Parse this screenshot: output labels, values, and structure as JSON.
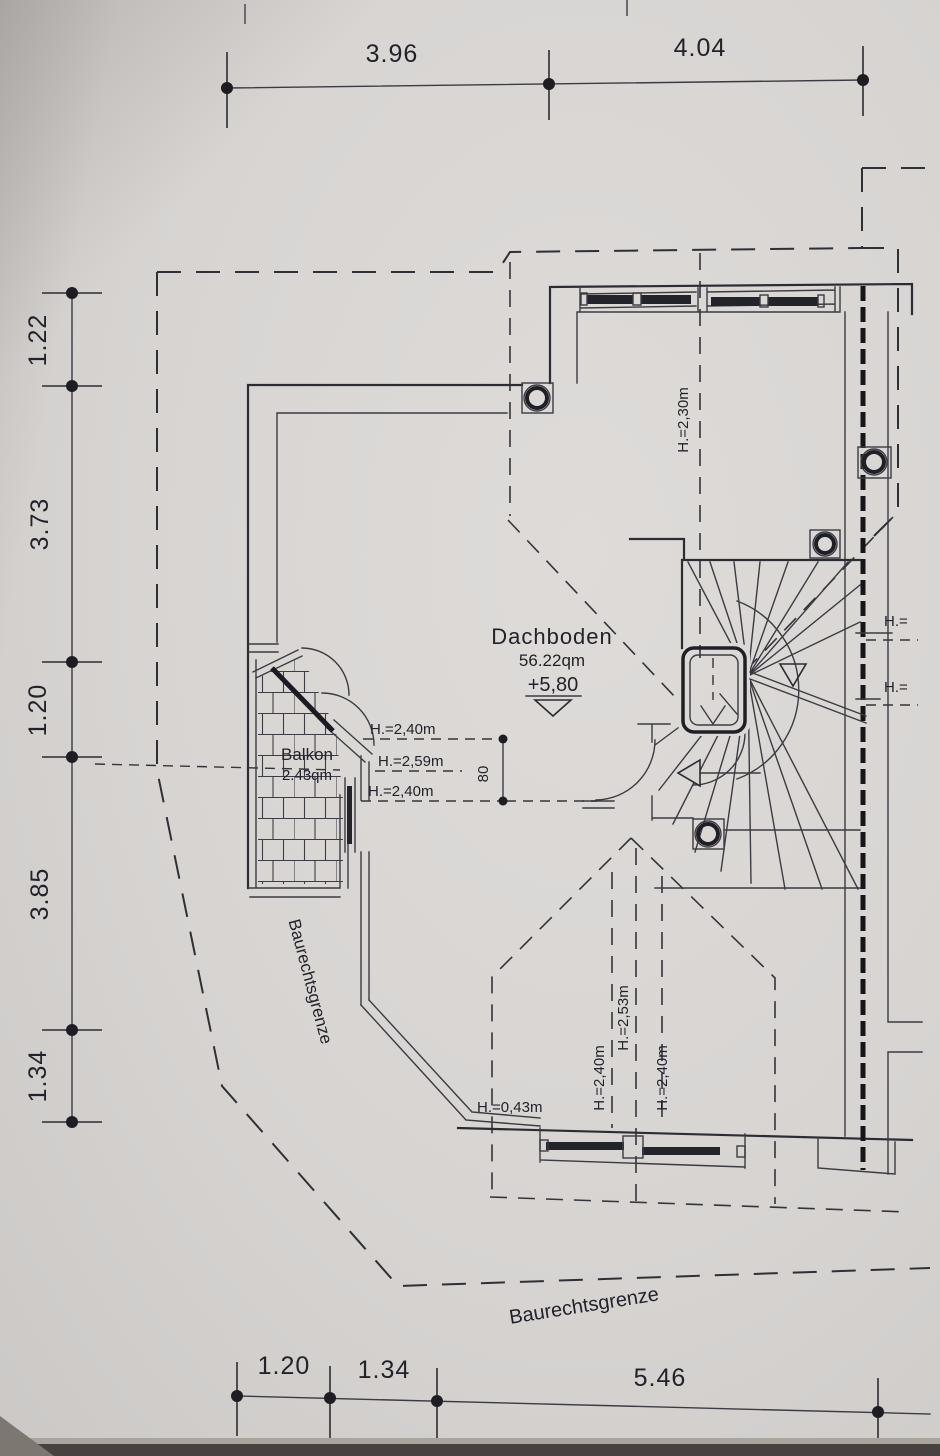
{
  "drawing": {
    "rooms": {
      "dachboden": {
        "label": "Dachboden",
        "area": "56.22qm",
        "level": "+5,80"
      },
      "balkon": {
        "label": "Balkon",
        "area": "2.43qm"
      }
    },
    "dimensions": {
      "top": {
        "d1": "3.96",
        "d2": "4.04"
      },
      "left": {
        "d1": "1.22",
        "d2": "3.73",
        "d3": "1.20",
        "d4": "3.85",
        "d5": "1.34"
      },
      "bottom": {
        "d1": "1.20",
        "d2": "1.34",
        "d3": "5.46"
      },
      "stair_opening": "80"
    },
    "heights": {
      "center_top": "H.=2,40m",
      "center_mid": "H.=2,59m",
      "center_bot": "H.=2,40m",
      "ridge_top": "H.=2,30m",
      "dormer_left": "H.=2,40m",
      "dormer_ridge": "H.=2,53m",
      "dormer_right": "H.=2,40m",
      "eave": "H.=0,43m",
      "cut1": "H.=",
      "cut2": "H.="
    },
    "boundaries": {
      "left": "Baurechtsgrenze",
      "bottom": "Baurechtsgrenze"
    },
    "colors": {
      "paper": "#d7d4d2",
      "ink": "#2c2c33"
    }
  }
}
